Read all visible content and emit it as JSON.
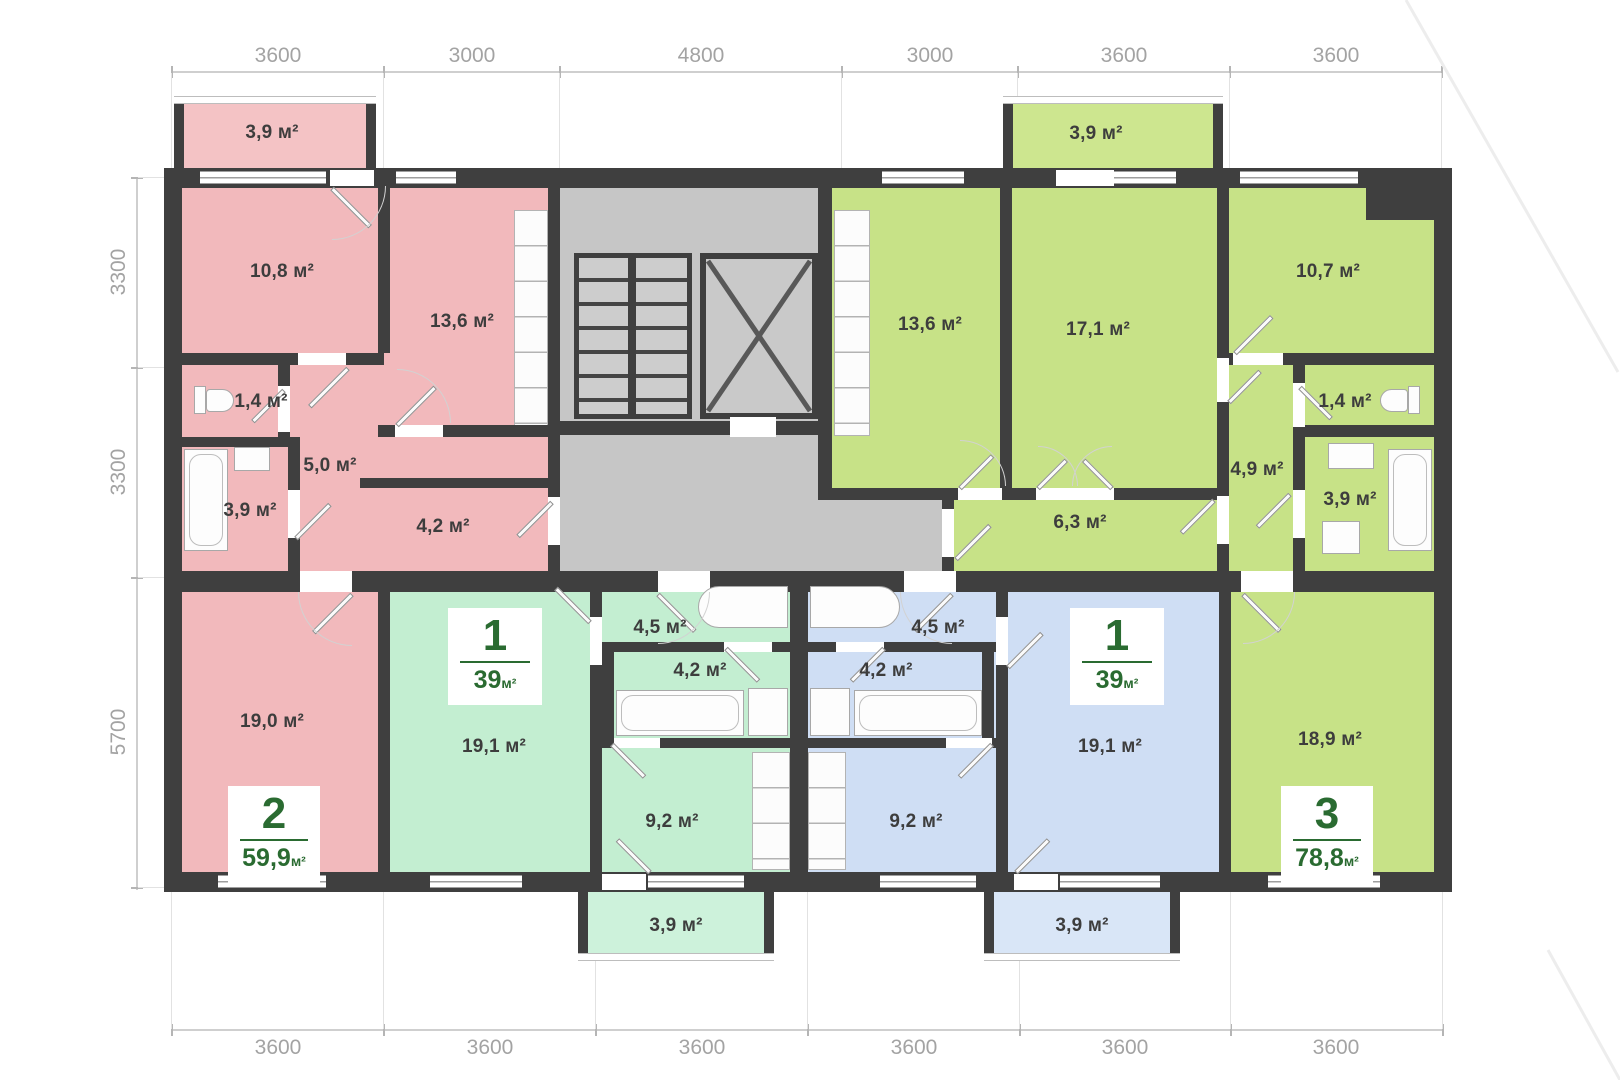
{
  "dims": {
    "top": [
      "3600",
      "3000",
      "4800",
      "3000",
      "3600",
      "3600"
    ],
    "left": [
      "3300",
      "3300",
      "5700"
    ],
    "bottom": [
      "3600",
      "3600",
      "3600",
      "3600",
      "3600",
      "3600"
    ]
  },
  "rooms": {
    "pink_balcony": "3,9 м²",
    "pink_room": "10,8 м²",
    "pink_kitchen": "13,6 м²",
    "pink_wc": "1,4 м²",
    "pink_hall": "5,0 м²",
    "pink_bath": "3,9 м²",
    "pink_corridor": "4,2 м²",
    "pink_living": "19,0 м²",
    "mint_hall": "4,5 м²",
    "mint_bath": "4,2 м²",
    "mint_living": "19,1 м²",
    "mint_kitchen": "9,2 м²",
    "mint_balcony": "3,9 м²",
    "blue_hall": "4,5 м²",
    "blue_bath": "4,2 м²",
    "blue_living": "19,1 м²",
    "blue_kitchen": "9,2 м²",
    "blue_balcony": "3,9 м²",
    "lime_balcony": "3,9 м²",
    "lime_kitchen": "13,6 м²",
    "lime_room1": "17,1 м²",
    "lime_room2": "10,7 м²",
    "lime_wc": "1,4 м²",
    "lime_hall": "4,9 м²",
    "lime_bath": "3,9 м²",
    "lime_corridor": "6,3 м²",
    "lime_living": "18,9 м²"
  },
  "apartments": {
    "pink": {
      "number": "2",
      "area": "59,9",
      "unit": "м²"
    },
    "mint": {
      "number": "1",
      "area": "39",
      "unit": "м²"
    },
    "blue": {
      "number": "1",
      "area": "39",
      "unit": "м²"
    },
    "lime": {
      "number": "3",
      "area": "78,8",
      "unit": "м²"
    }
  },
  "colors": {
    "pink": "#f2b9bc",
    "mint": "#c3eed1",
    "blue": "#cfdef4",
    "lime": "#c7e287",
    "wall": "#3f3f3f",
    "core_gray": "#c6c6c6",
    "badge_text": "#2a6b31",
    "dim_text": "#a3a3a3"
  }
}
